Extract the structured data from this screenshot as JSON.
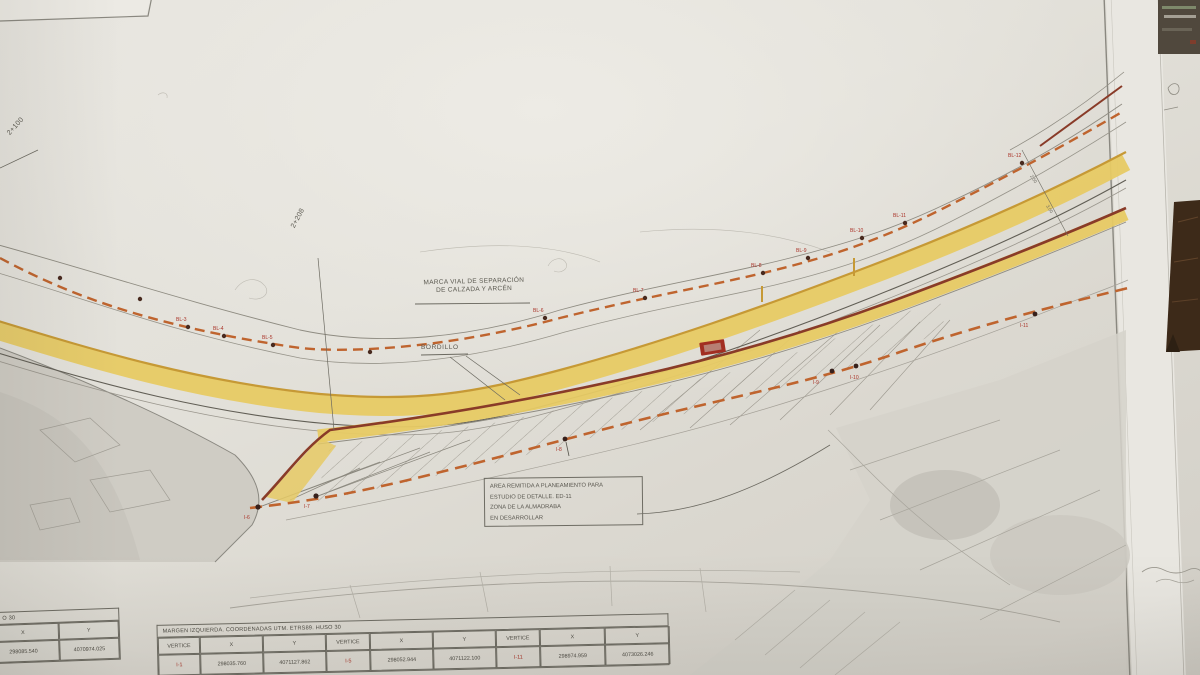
{
  "plan": {
    "road_labels": {
      "marca_vial_line1": "MARCA VIAL DE SEPARACIÓN",
      "marca_vial_line2": "DE CALZADA Y ARCÉN",
      "bordillo": "BORDILLO"
    },
    "stations": {
      "left": "2+100",
      "middle": "2+208"
    },
    "note_box": {
      "line1": "AREA REMITIDA A PLANEAMIENTO PARA",
      "line2": "ESTUDIO DE DETALLE. ED-11",
      "line3": "ZONA DE LA ALMADRABA",
      "line4": "EN DESARROLLAR"
    },
    "dims": {
      "d1": "2.50",
      "d2": "3.00"
    },
    "top_vertices": [
      "BL-3",
      "BL-4",
      "BL-5",
      "BL-6",
      "BL-7",
      "BL-8",
      "BL-9",
      "BL-10",
      "BL-11",
      "BL-12"
    ],
    "bottom_vertices": [
      "I-6",
      "I-7",
      "I-8",
      "I-9",
      "I-10",
      "I-11"
    ],
    "colors": {
      "shoulder_band_yellow": "#e9ca5e",
      "curb_dash_orange": "#c4632a",
      "edge_line_red": "#8d3a26",
      "vertex_label_red": "#b03226"
    }
  },
  "tables": {
    "main": {
      "title": "MARGEN IZQUIERDA. COORDENADAS UTM. ETRS89. HUSO 30",
      "headers": [
        "VERTICE",
        "X",
        "Y",
        "VERTICE",
        "X",
        "Y",
        "VERTICE",
        "X",
        "Y"
      ],
      "row": [
        "I-1",
        "298035.760",
        "4071127.862",
        "I-5",
        "298052.944",
        "4071122.100",
        "I-11",
        "298974.959",
        "4073026.246"
      ]
    },
    "left_partial": {
      "title": "O 30",
      "headers": [
        "X",
        "Y"
      ],
      "row": [
        "298085.540",
        "4070974.025"
      ]
    }
  }
}
